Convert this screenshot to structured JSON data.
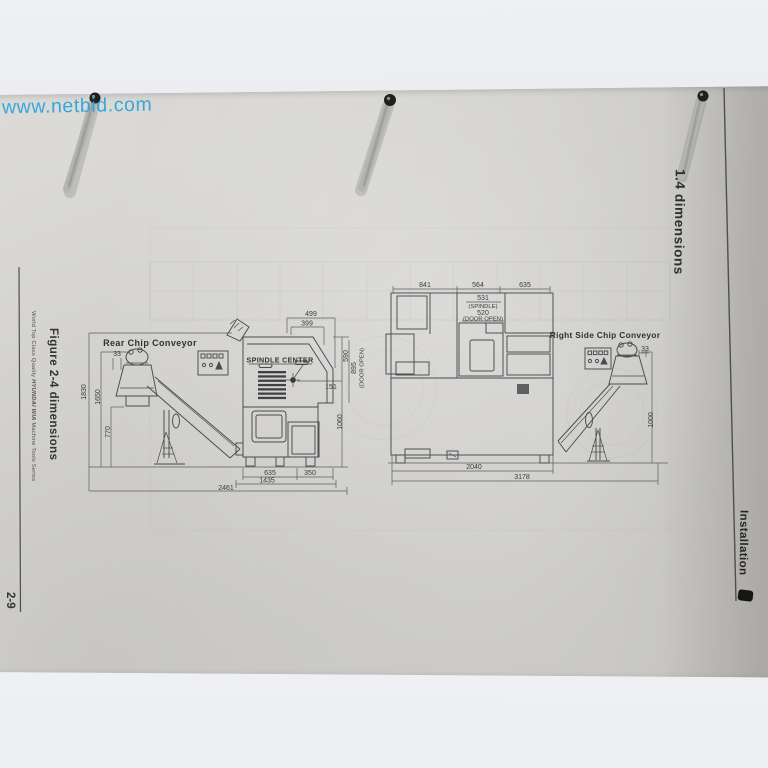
{
  "watermark": "www.netbid.com",
  "page": {
    "section_header": "1.4 dimensions",
    "chapter_tab": "Installation",
    "figure_caption": "Figure 2-4 dimensions",
    "page_number": "2-9",
    "sidebar_prefix": "World Top Class Quality ",
    "sidebar_brand": "HYUNDAI WIA",
    "sidebar_suffix": " Machine Tools Series"
  },
  "front_view": {
    "title": "Rear Chip Conveyor",
    "spindle_center_label": "SPINDLE CENTER",
    "dims": {
      "offset": "33",
      "h_overall": "1830",
      "h_conveyor": "1650",
      "h_tank": "770",
      "w_top_outer": "499",
      "w_top_inner": "399",
      "h_spindle_to_top": "590",
      "door_open_value": "895",
      "door_open_label": "(DOOR OPEN)",
      "spindle_offset": "151",
      "h_spindle": "1060",
      "w_base_left": "635",
      "w_base_right": "350",
      "w_body": "1435",
      "w_overall": "2461"
    }
  },
  "side_view": {
    "title": "Right Side Chip Conveyor",
    "dims": {
      "w_left": "841",
      "w_mid": "564",
      "w_right": "635",
      "spindle_value": "531",
      "spindle_label": "(SPINDLE)",
      "door_value": "520",
      "door_label": "(DOOR OPEN)",
      "offset": "33",
      "h_conveyor": "1000",
      "w_machine": "2040",
      "w_overall": "3178"
    }
  }
}
